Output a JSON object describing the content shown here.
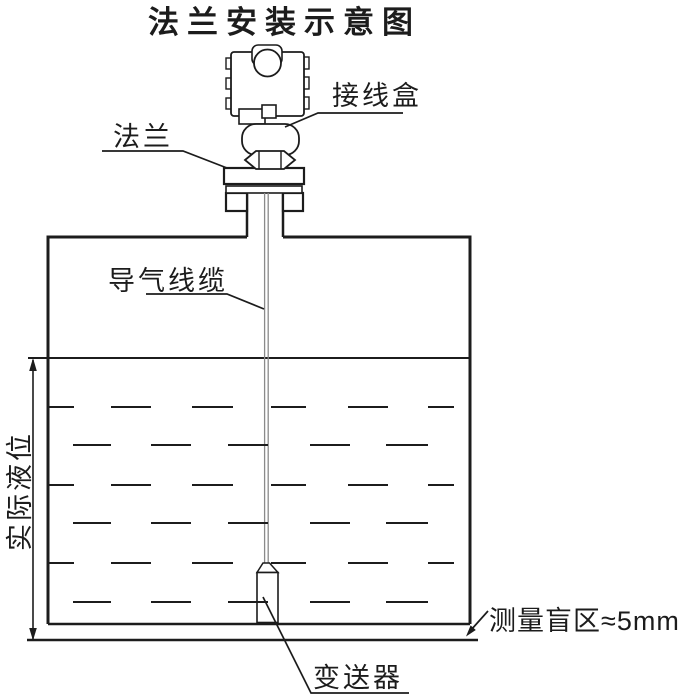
{
  "title": "法兰安装示意图",
  "labels": {
    "junction_box": "接线盒",
    "flange": "法兰",
    "air_cable": "导气线缆",
    "actual_level": "实际液位",
    "transmitter": "变送器",
    "blind_zone": "测量盲区≈5mm"
  },
  "annotations": {
    "blind_zone_value": "≈5mm"
  },
  "colors": {
    "ink": "#1c1c1c",
    "background": "#ffffff",
    "cable": "#8a8a8a"
  }
}
